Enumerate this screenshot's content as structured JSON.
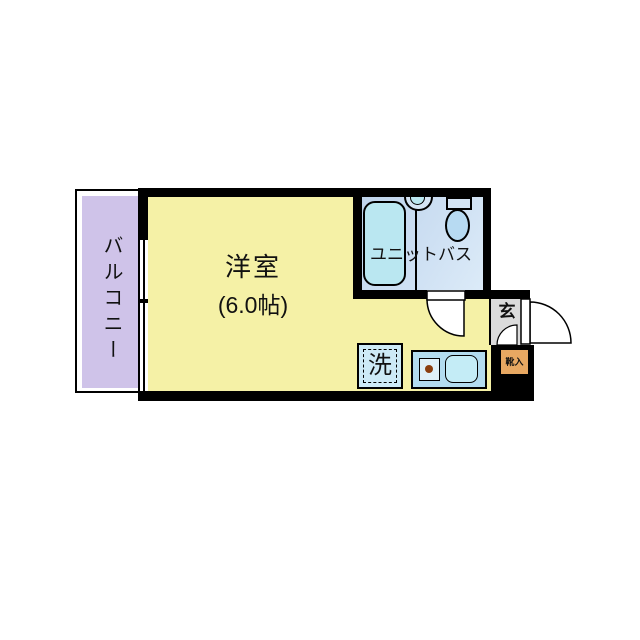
{
  "floorplan": {
    "title": "1R apartment floor plan",
    "balcony": {
      "label": "バルコニー"
    },
    "room": {
      "label": "洋室",
      "size": "(6.0帖)"
    },
    "bath": {
      "label": "ユニットバス"
    },
    "entrance": {
      "label": "玄"
    },
    "shoe_box": {
      "label": "靴入"
    },
    "washer": {
      "label": "洗"
    },
    "colors": {
      "room_floor": "#F5F1A6",
      "balcony_floor": "#CFC3E9",
      "bath_floor": "#C7DAEE",
      "bathtub": "#BAE7F1",
      "kitchen_counter": "#B3DCEF",
      "kitchen_sink": "#C4ECF6",
      "stove_dot": "#8B3E0F",
      "entrance_floor": "#DBDBDB",
      "shoe_box": "#E8A862",
      "wall": "#000000"
    }
  }
}
